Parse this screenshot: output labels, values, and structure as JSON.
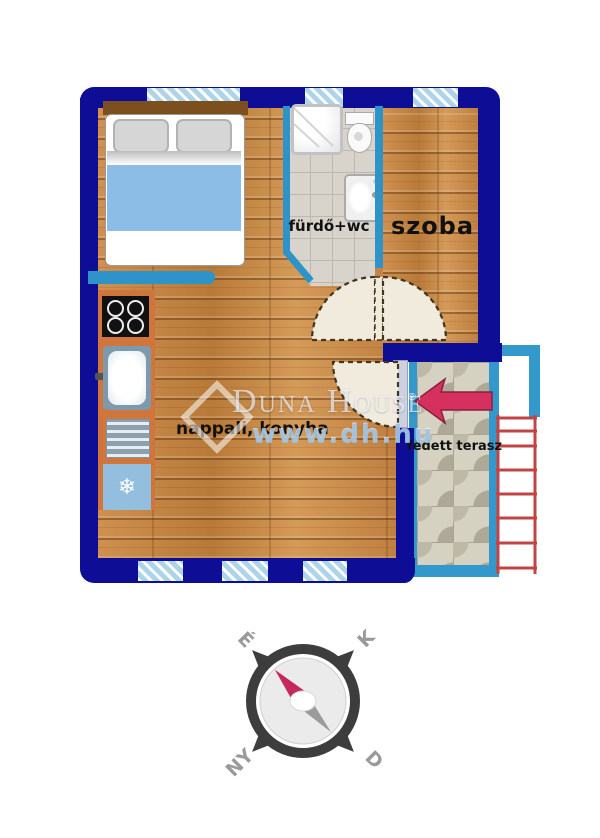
{
  "colors": {
    "wall": "#0d0d96",
    "interior-wall": "#2e93c8",
    "window": "#aed4ea",
    "wood": "#c8884a",
    "tile-bath": "#d8d4cc",
    "tile-terrace": "#d6d2c2",
    "terrace-border": "#3399cc",
    "arrow": "#d6305f",
    "railing": "#c24545",
    "blanket": "#8cbde6",
    "counter": "#d0763c",
    "fridge": "#93bedd",
    "label": "#111111",
    "compass-ring": "#3d3d3d",
    "compass-needle-red": "#c5295c",
    "compass-needle-gray": "#9b9b9b",
    "compass-label": "#9a9a9a",
    "watermark": "rgba(255,255,255,0.62)",
    "watermark-url": "rgba(150,190,225,0.85)"
  },
  "rooms": {
    "bathroom": {
      "label": "fürdő+wc"
    },
    "room": {
      "label": "szoba"
    },
    "living_kitchen": {
      "label": "nappali, konyha"
    },
    "terrace": {
      "label": "fedett terasz"
    }
  },
  "watermark": {
    "brand": "Duna House",
    "reg": "®",
    "url": "www.dh.hu"
  },
  "compass": {
    "north": "É",
    "east": "K",
    "west": "NY",
    "south": "D"
  },
  "icons": {
    "freezer": "❄"
  }
}
